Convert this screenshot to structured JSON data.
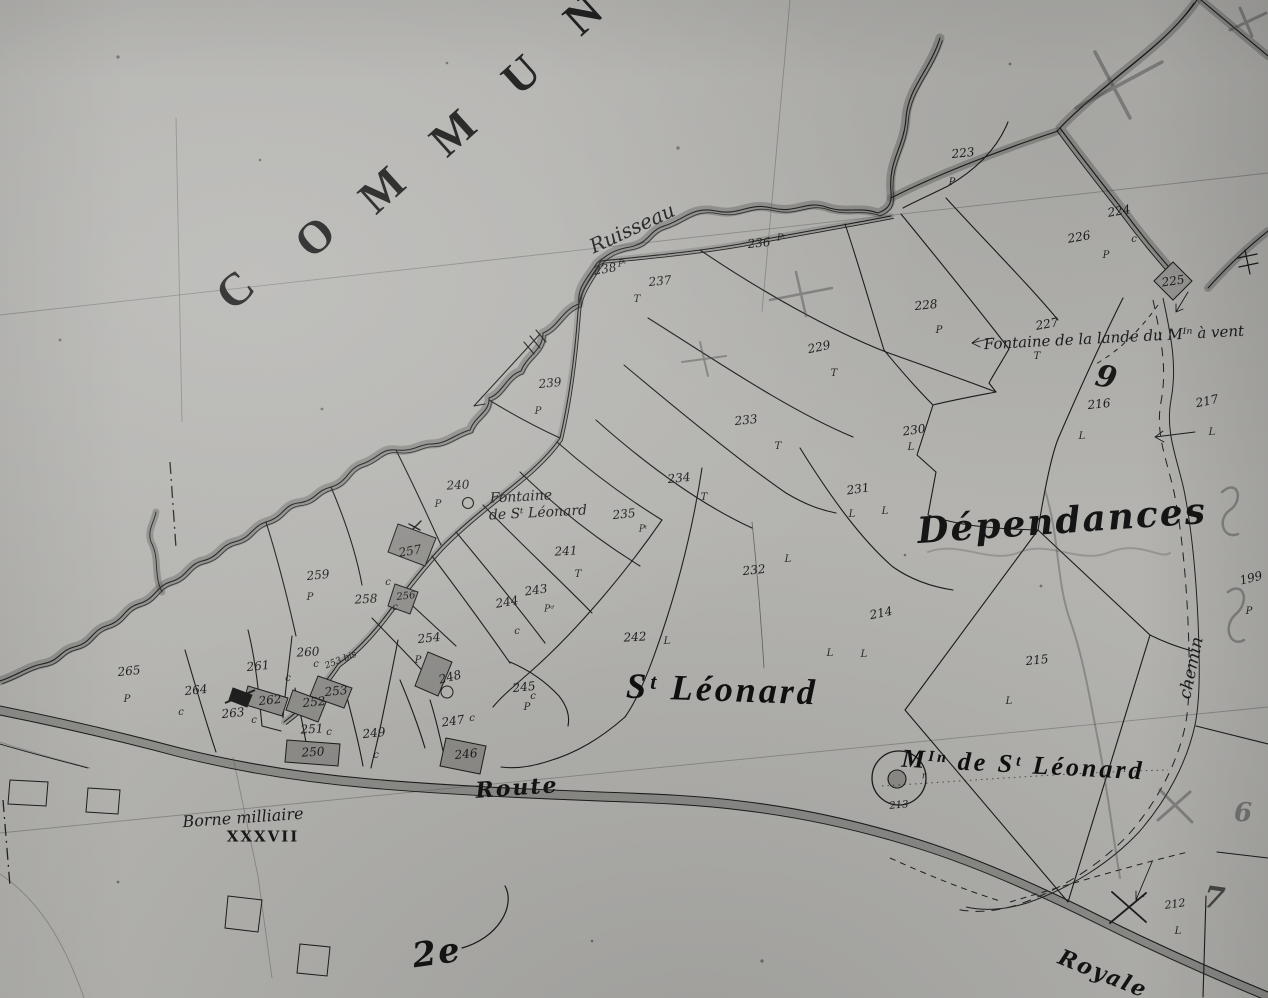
{
  "map": {
    "kind": "scanned cadastral plan (grayscale)",
    "village_name": "St Léonard",
    "sheet_mark": "2e"
  },
  "place_labels": [
    {
      "name": "commune-letter",
      "text": "C",
      "x": 235,
      "y": 290,
      "size": 46,
      "rot": -42,
      "cls": "caps"
    },
    {
      "name": "commune-letter",
      "text": "O",
      "x": 315,
      "y": 237,
      "size": 46,
      "rot": -42,
      "cls": "caps"
    },
    {
      "name": "commune-letter",
      "text": "M",
      "x": 382,
      "y": 190,
      "size": 46,
      "rot": -42,
      "cls": "caps"
    },
    {
      "name": "commune-letter",
      "text": "M",
      "x": 453,
      "y": 133,
      "size": 46,
      "rot": -42,
      "cls": "caps"
    },
    {
      "name": "commune-letter",
      "text": "U",
      "x": 521,
      "y": 75,
      "size": 46,
      "rot": -42,
      "cls": "caps"
    },
    {
      "name": "commune-letter",
      "text": "N",
      "x": 583,
      "y": 15,
      "size": 46,
      "rot": -42,
      "cls": "caps"
    },
    {
      "name": "ruisseau-label",
      "text": "Ruisseau",
      "x": 632,
      "y": 228,
      "size": 20,
      "rot": -25,
      "cls": "script"
    },
    {
      "name": "fontaine-lande-label",
      "text": "Fontaine de la lande du Mᴵⁿ à vent",
      "x": 1114,
      "y": 338,
      "size": 15,
      "rot": -3,
      "cls": "script"
    },
    {
      "name": "fontaine-stleonard-label-1",
      "text": "Fontaine",
      "x": 521,
      "y": 497,
      "size": 14,
      "rot": -3,
      "cls": "script"
    },
    {
      "name": "fontaine-stleonard-label-2",
      "text": "de Sᵗ Léonard",
      "x": 538,
      "y": 513,
      "size": 14,
      "rot": -3,
      "cls": "script"
    },
    {
      "name": "dependances-label",
      "text": "Dépendances",
      "x": 1062,
      "y": 521,
      "size": 36,
      "rot": -4,
      "cls": "script-big"
    },
    {
      "name": "st-leonard-label",
      "text": "Sᵗ Léonard",
      "x": 722,
      "y": 689,
      "size": 36,
      "rot": 2,
      "cls": "display"
    },
    {
      "name": "moulin-st-leonard-label",
      "text": "Mᴵⁿ de Sᵗ Léonard",
      "x": 1023,
      "y": 765,
      "size": 26,
      "rot": 3,
      "cls": "display"
    },
    {
      "name": "chemin-label",
      "text": "chemin",
      "x": 1192,
      "y": 668,
      "size": 17,
      "rot": -78,
      "cls": "script"
    },
    {
      "name": "route-label",
      "text": "Route",
      "x": 517,
      "y": 788,
      "size": 22,
      "rot": -4,
      "cls": "script-big"
    },
    {
      "name": "royale-label",
      "text": "Royale",
      "x": 1103,
      "y": 974,
      "size": 22,
      "rot": 22,
      "cls": "script-big"
    },
    {
      "name": "borne-milliaire-label",
      "text": "Borne milliaire",
      "x": 243,
      "y": 818,
      "size": 16,
      "rot": -4,
      "cls": "script"
    },
    {
      "name": "borne-milliaire-number",
      "text": "XXXVII",
      "x": 263,
      "y": 837,
      "size": 15,
      "rot": 0,
      "cls": "roman"
    },
    {
      "name": "sheet-mark",
      "text": "2e",
      "x": 437,
      "y": 953,
      "size": 34,
      "rot": -8,
      "cls": "script-big"
    },
    {
      "name": "ink-numeral-9",
      "text": "9",
      "x": 1106,
      "y": 378,
      "size": 30,
      "rot": 12,
      "cls": "ink9"
    },
    {
      "name": "pencil-numeral-6",
      "text": "6",
      "x": 1243,
      "y": 813,
      "size": 26,
      "rot": 0,
      "cls": "pencil-num"
    },
    {
      "name": "pencil-numeral-7",
      "text": "7",
      "x": 1214,
      "y": 899,
      "size": 30,
      "rot": 8,
      "cls": "pencil-dark"
    }
  ],
  "parcel_labels": [
    {
      "text": "223",
      "x": 963,
      "y": 153,
      "rot": -6
    },
    {
      "text": "224",
      "x": 1119,
      "y": 211,
      "rot": -10
    },
    {
      "text": "226",
      "x": 1079,
      "y": 237,
      "rot": -10
    },
    {
      "text": "225",
      "x": 1173,
      "y": 281,
      "rot": -8
    },
    {
      "text": "227",
      "x": 1047,
      "y": 324,
      "rot": -10
    },
    {
      "text": "228",
      "x": 926,
      "y": 305,
      "rot": -6
    },
    {
      "text": "229",
      "x": 819,
      "y": 347,
      "rot": -12
    },
    {
      "text": "216",
      "x": 1099,
      "y": 404,
      "rot": -6
    },
    {
      "text": "217",
      "x": 1207,
      "y": 401,
      "rot": -12
    },
    {
      "text": "230",
      "x": 914,
      "y": 430,
      "rot": -8
    },
    {
      "text": "233",
      "x": 746,
      "y": 420,
      "rot": -6
    },
    {
      "text": "231",
      "x": 858,
      "y": 489,
      "rot": -8
    },
    {
      "text": "234",
      "x": 679,
      "y": 478,
      "rot": -6
    },
    {
      "text": "236",
      "x": 759,
      "y": 243,
      "rot": -6
    },
    {
      "text": "237",
      "x": 660,
      "y": 281,
      "rot": -6
    },
    {
      "text": "238",
      "x": 605,
      "y": 269,
      "rot": -10
    },
    {
      "text": "239",
      "x": 550,
      "y": 383,
      "rot": -6
    },
    {
      "text": "240",
      "x": 458,
      "y": 485,
      "rot": -3
    },
    {
      "text": "241",
      "x": 566,
      "y": 551,
      "rot": -3
    },
    {
      "text": "235",
      "x": 624,
      "y": 514,
      "rot": -6
    },
    {
      "text": "243",
      "x": 536,
      "y": 590,
      "rot": -8
    },
    {
      "text": "244",
      "x": 507,
      "y": 602,
      "rot": -10
    },
    {
      "text": "242",
      "x": 635,
      "y": 637,
      "rot": -3
    },
    {
      "text": "232",
      "x": 754,
      "y": 570,
      "rot": -6
    },
    {
      "text": "214",
      "x": 881,
      "y": 613,
      "rot": -12
    },
    {
      "text": "215",
      "x": 1037,
      "y": 660,
      "rot": -6
    },
    {
      "text": "199",
      "x": 1251,
      "y": 578,
      "rot": -14
    },
    {
      "text": "213",
      "x": 899,
      "y": 806,
      "rot": -5,
      "size": 10
    },
    {
      "text": "212",
      "x": 1175,
      "y": 904,
      "rot": -8,
      "size": 11
    },
    {
      "text": "245",
      "x": 524,
      "y": 687,
      "rot": -6
    },
    {
      "text": "246",
      "x": 466,
      "y": 754,
      "rot": -6
    },
    {
      "text": "247",
      "x": 453,
      "y": 721,
      "rot": -8
    },
    {
      "text": "248",
      "x": 450,
      "y": 677,
      "rot": -14
    },
    {
      "text": "249",
      "x": 374,
      "y": 733,
      "rot": -6
    },
    {
      "text": "250",
      "x": 313,
      "y": 752,
      "rot": -3
    },
    {
      "text": "251",
      "x": 312,
      "y": 729,
      "rot": -3
    },
    {
      "text": "252",
      "x": 314,
      "y": 702,
      "rot": -6
    },
    {
      "text": "253",
      "x": 336,
      "y": 691,
      "rot": -6
    },
    {
      "text": "253 bis",
      "x": 341,
      "y": 661,
      "rot": -22,
      "size": 9,
      "cls": "num-small"
    },
    {
      "text": "254",
      "x": 429,
      "y": 638,
      "rot": -6
    },
    {
      "text": "256",
      "x": 406,
      "y": 597,
      "rot": -6,
      "size": 10
    },
    {
      "text": "257",
      "x": 410,
      "y": 551,
      "rot": -10
    },
    {
      "text": "258",
      "x": 366,
      "y": 599,
      "rot": -3
    },
    {
      "text": "259",
      "x": 318,
      "y": 575,
      "rot": -6
    },
    {
      "text": "260",
      "x": 308,
      "y": 652,
      "rot": -3
    },
    {
      "text": "261",
      "x": 258,
      "y": 666,
      "rot": -6
    },
    {
      "text": "262",
      "x": 270,
      "y": 700,
      "rot": -6
    },
    {
      "text": "263",
      "x": 233,
      "y": 713,
      "rot": -6
    },
    {
      "text": "264",
      "x": 196,
      "y": 690,
      "rot": -6
    },
    {
      "text": "265",
      "x": 129,
      "y": 671,
      "rot": -6
    }
  ],
  "class_letters": [
    {
      "text": "P",
      "x": 952,
      "y": 183
    },
    {
      "text": "c",
      "x": 1134,
      "y": 240
    },
    {
      "text": "P",
      "x": 1106,
      "y": 256
    },
    {
      "text": "T",
      "x": 1037,
      "y": 357
    },
    {
      "text": "P",
      "x": 939,
      "y": 331
    },
    {
      "text": "T",
      "x": 834,
      "y": 374
    },
    {
      "text": "L",
      "x": 1082,
      "y": 437
    },
    {
      "text": "L",
      "x": 1212,
      "y": 433
    },
    {
      "text": "L",
      "x": 911,
      "y": 448
    },
    {
      "text": "T",
      "x": 778,
      "y": 447
    },
    {
      "text": "L",
      "x": 852,
      "y": 515
    },
    {
      "text": "L",
      "x": 885,
      "y": 512
    },
    {
      "text": "T",
      "x": 704,
      "y": 498
    },
    {
      "text": "Pᵗ",
      "x": 781,
      "y": 239,
      "size": 9
    },
    {
      "text": "T",
      "x": 637,
      "y": 300
    },
    {
      "text": "Pᵗ",
      "x": 622,
      "y": 265,
      "size": 9
    },
    {
      "text": "P",
      "x": 538,
      "y": 412
    },
    {
      "text": "P",
      "x": 438,
      "y": 505
    },
    {
      "text": "T",
      "x": 578,
      "y": 575
    },
    {
      "text": "Pᵗ",
      "x": 643,
      "y": 530,
      "size": 9
    },
    {
      "text": "Pᵈ",
      "x": 549,
      "y": 610,
      "size": 9
    },
    {
      "text": "c",
      "x": 517,
      "y": 632
    },
    {
      "text": "L",
      "x": 667,
      "y": 642
    },
    {
      "text": "L",
      "x": 830,
      "y": 654
    },
    {
      "text": "L",
      "x": 788,
      "y": 560
    },
    {
      "text": "L",
      "x": 864,
      "y": 655
    },
    {
      "text": "L",
      "x": 1009,
      "y": 702
    },
    {
      "text": "P",
      "x": 1249,
      "y": 612
    },
    {
      "text": "L",
      "x": 1178,
      "y": 932
    },
    {
      "text": "c",
      "x": 533,
      "y": 697
    },
    {
      "text": "P",
      "x": 527,
      "y": 708
    },
    {
      "text": "c",
      "x": 472,
      "y": 719
    },
    {
      "text": "c",
      "x": 376,
      "y": 756
    },
    {
      "text": "c",
      "x": 329,
      "y": 733
    },
    {
      "text": "P",
      "x": 418,
      "y": 661
    },
    {
      "text": "c",
      "x": 388,
      "y": 583
    },
    {
      "text": "c",
      "x": 395,
      "y": 608
    },
    {
      "text": "P",
      "x": 310,
      "y": 598
    },
    {
      "text": "c",
      "x": 316,
      "y": 665
    },
    {
      "text": "c",
      "x": 288,
      "y": 679
    },
    {
      "text": "c",
      "x": 254,
      "y": 721
    },
    {
      "text": "c",
      "x": 181,
      "y": 713
    },
    {
      "text": "P",
      "x": 127,
      "y": 700
    },
    {
      "text": "r",
      "x": 924,
      "y": 777,
      "size": 9
    }
  ],
  "colors": {
    "paper": "#b4b3b0",
    "ink": "#1c1c1c",
    "wash": "rgba(96,96,94,0.45)",
    "building_fill": "#8e8d8a",
    "pencil": "rgba(70,70,70,0.45)"
  }
}
